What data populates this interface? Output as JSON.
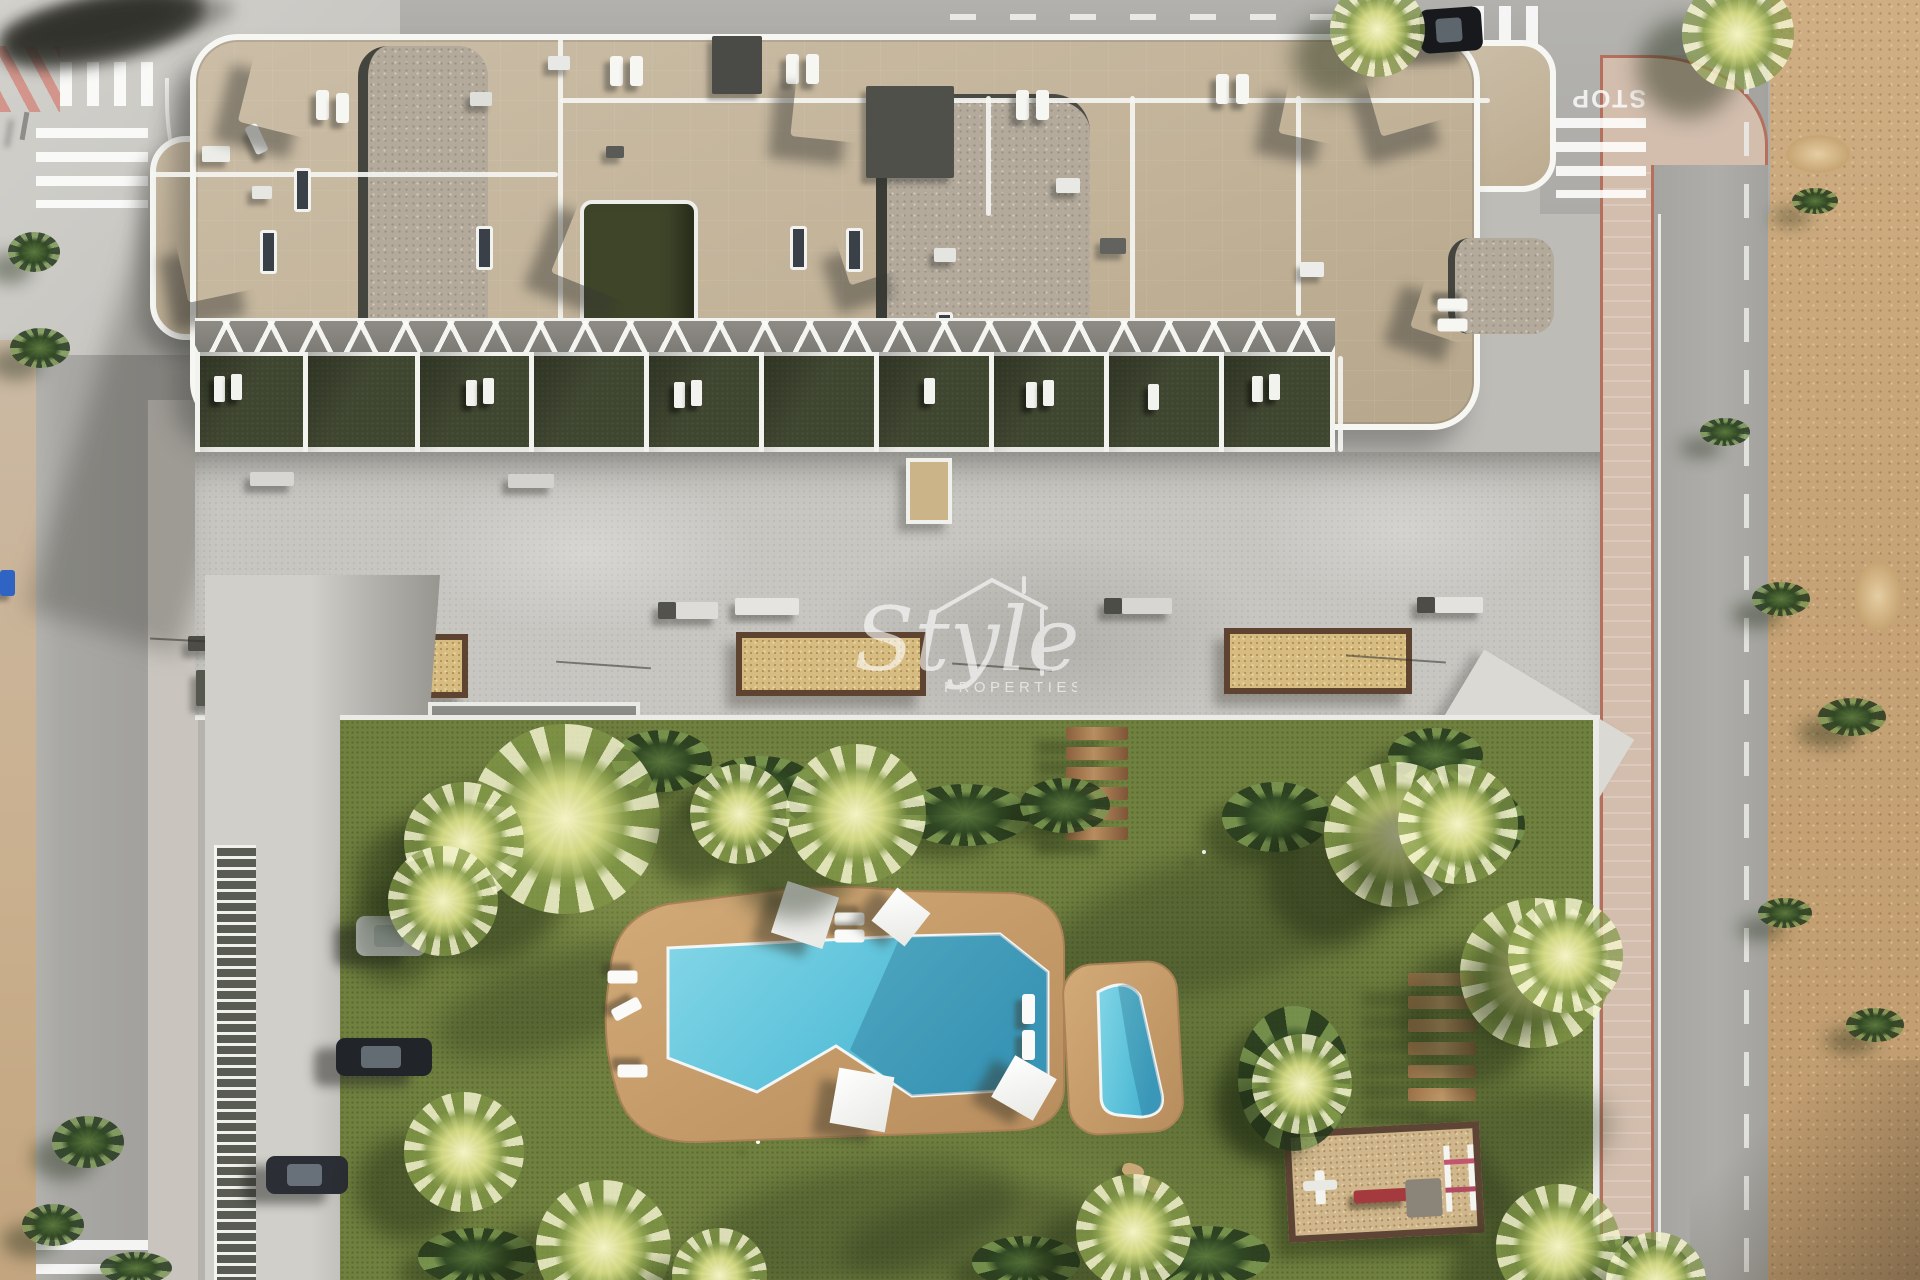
{
  "scene": {
    "description": "aerial-architectural-render-of-residential-complex-with-pool-garden",
    "watermark": {
      "brand_script": "Style",
      "brand_sub": "PROPERTIES"
    },
    "road_markings": {
      "stop_label": "STOP"
    },
    "palette": {
      "asphalt": "#a9a8a4",
      "concrete_plaza": "#c7c6c1",
      "building_stone": "#c2b399",
      "gravel_roof": "#b3aa9c",
      "terrace_grass": "#3f4630",
      "lawn_green": "#70803f",
      "pool_water": "#5fc8de",
      "pool_water_shadow": "#3e9ec0",
      "deck_tan": "#c59d6d",
      "planter_sand": "#d6bc80",
      "sidewalk_pink": "#d3beae",
      "sand_lot": "#c7a477",
      "wood_brown": "#9a7148",
      "white_architecture": "#f6f6f3"
    }
  },
  "sprites": {
    "sails": [
      {
        "x": 246,
        "y": 54,
        "s": 78,
        "r": "14deg"
      },
      {
        "x": 180,
        "y": 222,
        "s": 74,
        "r": "-12deg"
      },
      {
        "x": 564,
        "y": 204,
        "s": 88,
        "r": "22deg"
      },
      {
        "x": 794,
        "y": 66,
        "s": 74,
        "r": "6deg"
      },
      {
        "x": 840,
        "y": 220,
        "s": 58,
        "r": "-18deg"
      },
      {
        "x": 1284,
        "y": 78,
        "s": 62,
        "r": "12deg"
      },
      {
        "x": 1370,
        "y": 54,
        "s": 74,
        "r": "-16deg"
      },
      {
        "x": 1418,
        "y": 276,
        "s": 62,
        "r": "18deg"
      }
    ],
    "roof_units": [
      {
        "x": 202,
        "y": 146,
        "w": 28,
        "h": 16,
        "c": "#ecece9"
      },
      {
        "x": 252,
        "y": 186,
        "w": 20,
        "h": 13,
        "c": "#e6e6e3"
      },
      {
        "x": 470,
        "y": 92,
        "w": 22,
        "h": 14,
        "c": "#dededb"
      },
      {
        "x": 712,
        "y": 36,
        "w": 50,
        "h": 58,
        "c": "#4a4a46"
      },
      {
        "x": 866,
        "y": 86,
        "w": 88,
        "h": 92,
        "c": "#50504b"
      },
      {
        "x": 1056,
        "y": 178,
        "w": 24,
        "h": 15,
        "c": "#e8e8e5"
      },
      {
        "x": 1100,
        "y": 238,
        "w": 26,
        "h": 16,
        "c": "#62625e"
      },
      {
        "x": 934,
        "y": 248,
        "w": 22,
        "h": 14,
        "c": "#e4e4e1"
      },
      {
        "x": 1300,
        "y": 262,
        "w": 24,
        "h": 15,
        "c": "#ececea"
      },
      {
        "x": 548,
        "y": 56,
        "w": 22,
        "h": 14,
        "c": "#e8e8e6"
      },
      {
        "x": 606,
        "y": 146,
        "w": 18,
        "h": 12,
        "c": "#5a5a56"
      }
    ],
    "skylights": [
      {
        "x": 294,
        "y": 168
      },
      {
        "x": 260,
        "y": 230
      },
      {
        "x": 476,
        "y": 226
      },
      {
        "x": 790,
        "y": 226
      },
      {
        "x": 846,
        "y": 228
      },
      {
        "x": 936,
        "y": 312
      }
    ],
    "roof_loungers": [
      {
        "x": 316,
        "y": 90
      },
      {
        "x": 336,
        "y": 93
      },
      {
        "x": 250,
        "y": 124,
        "r": "-25deg"
      },
      {
        "x": 262,
        "y": 326,
        "r": "90deg"
      },
      {
        "x": 262,
        "y": 344,
        "r": "90deg"
      },
      {
        "x": 292,
        "y": 318
      },
      {
        "x": 610,
        "y": 56
      },
      {
        "x": 630,
        "y": 56
      },
      {
        "x": 786,
        "y": 54
      },
      {
        "x": 806,
        "y": 54
      },
      {
        "x": 1016,
        "y": 90
      },
      {
        "x": 1036,
        "y": 90
      },
      {
        "x": 1216,
        "y": 74
      },
      {
        "x": 1236,
        "y": 74
      },
      {
        "x": 1446,
        "y": 290,
        "r": "90deg"
      },
      {
        "x": 1446,
        "y": 310,
        "r": "90deg"
      }
    ],
    "terrace_cells": [
      {
        "x": 195,
        "w": 108
      },
      {
        "x": 303,
        "w": 112
      },
      {
        "x": 415,
        "w": 114
      },
      {
        "x": 529,
        "w": 115
      },
      {
        "x": 644,
        "w": 115
      },
      {
        "x": 759,
        "w": 115
      },
      {
        "x": 874,
        "w": 115
      },
      {
        "x": 989,
        "w": 115
      },
      {
        "x": 1104,
        "w": 115
      },
      {
        "x": 1219,
        "w": 116
      }
    ],
    "terrace_loungers": [
      {
        "x": 214,
        "y": 376
      },
      {
        "x": 231,
        "y": 374
      },
      {
        "x": 466,
        "y": 380
      },
      {
        "x": 483,
        "y": 378
      },
      {
        "x": 674,
        "y": 382
      },
      {
        "x": 691,
        "y": 380
      },
      {
        "x": 924,
        "y": 378
      },
      {
        "x": 1026,
        "y": 382
      },
      {
        "x": 1043,
        "y": 380
      },
      {
        "x": 1252,
        "y": 376
      },
      {
        "x": 1269,
        "y": 374
      },
      {
        "x": 1148,
        "y": 384
      }
    ],
    "planters": [
      {
        "x": 318,
        "y": 634,
        "w": 150,
        "h": 64
      },
      {
        "x": 736,
        "y": 632,
        "w": 190,
        "h": 64
      },
      {
        "x": 1224,
        "y": 628,
        "w": 188,
        "h": 66
      }
    ],
    "plaza_benches": [
      {
        "x": 208,
        "y": 636,
        "w": 80,
        "h": 15,
        "c": "#eceae6"
      },
      {
        "x": 188,
        "y": 636,
        "w": 20,
        "h": 15,
        "c": "#4c4d47"
      },
      {
        "x": 196,
        "y": 670,
        "w": 22,
        "h": 36,
        "c": "#56574f"
      },
      {
        "x": 676,
        "y": 602,
        "w": 42,
        "h": 17,
        "c": "#dedcd8"
      },
      {
        "x": 658,
        "y": 602,
        "w": 18,
        "h": 17,
        "c": "#52534d"
      },
      {
        "x": 735,
        "y": 598,
        "w": 64,
        "h": 17,
        "c": "#e6e4e0"
      },
      {
        "x": 1122,
        "y": 598,
        "w": 50,
        "h": 16,
        "c": "#d8d6d2"
      },
      {
        "x": 1104,
        "y": 598,
        "w": 18,
        "h": 16,
        "c": "#4c4d47"
      },
      {
        "x": 1435,
        "y": 597,
        "w": 48,
        "h": 16,
        "c": "#e4e2de"
      },
      {
        "x": 1417,
        "y": 597,
        "w": 18,
        "h": 16,
        "c": "#4c4d47"
      },
      {
        "x": 508,
        "y": 474,
        "w": 46,
        "h": 14,
        "c": "#d4d2ce"
      },
      {
        "x": 250,
        "y": 472,
        "w": 44,
        "h": 14,
        "c": "#d8d6d2"
      }
    ],
    "pole_shadows": [
      {
        "x": 556,
        "y": 664,
        "w": 95,
        "r": "4deg"
      },
      {
        "x": 952,
        "y": 666,
        "w": 100,
        "r": "4deg"
      },
      {
        "x": 1346,
        "y": 658,
        "w": 100,
        "r": "4deg"
      },
      {
        "x": 150,
        "y": 642,
        "w": 170,
        "r": "3deg"
      }
    ],
    "wood_steps": [
      {
        "x": 1066,
        "y": 727
      },
      {
        "x": 1066,
        "y": 747
      },
      {
        "x": 1066,
        "y": 767
      },
      {
        "x": 1066,
        "y": 787
      },
      {
        "x": 1066,
        "y": 807
      },
      {
        "x": 1066,
        "y": 827
      }
    ],
    "wood_benches": [
      {
        "x": 1408,
        "y": 973
      },
      {
        "x": 1408,
        "y": 996
      },
      {
        "x": 1408,
        "y": 1019
      },
      {
        "x": 1408,
        "y": 1042
      },
      {
        "x": 1408,
        "y": 1065
      },
      {
        "x": 1408,
        "y": 1088
      }
    ],
    "parking_lines": [
      {
        "x": 366,
        "y": 912
      },
      {
        "x": 366,
        "y": 995
      },
      {
        "x": 364,
        "y": 1080
      },
      {
        "x": 362,
        "y": 1155
      },
      {
        "x": 360,
        "y": 1235
      }
    ],
    "cars": [
      {
        "x": 356,
        "y": 916,
        "w": 70,
        "h": 40,
        "c": "#e8e9eb"
      },
      {
        "x": 336,
        "y": 1038,
        "w": 96,
        "h": 38,
        "c": "#212429"
      },
      {
        "x": 266,
        "y": 1156,
        "w": 82,
        "h": 38,
        "c": "#2b2e34"
      },
      {
        "x": 1420,
        "y": 8,
        "w": 62,
        "h": 44,
        "c": "#17191d",
        "r": "-4deg"
      }
    ],
    "light_dots": [
      {
        "x": 866,
        "y": 796
      },
      {
        "x": 1202,
        "y": 850
      },
      {
        "x": 756,
        "y": 1140
      }
    ],
    "lawn_shadows": [
      {
        "x": 430,
        "y": 952,
        "w": 270,
        "h": 95,
        "r": "-18deg"
      },
      {
        "x": 690,
        "y": 1165,
        "w": 330,
        "h": 115,
        "r": "-12deg"
      },
      {
        "x": 1030,
        "y": 850,
        "w": 390,
        "h": 135,
        "r": "-16deg"
      },
      {
        "x": 1310,
        "y": 1105,
        "w": 310,
        "h": 125,
        "r": "-20deg"
      },
      {
        "x": 468,
        "y": 756,
        "w": 200,
        "h": 80,
        "r": "-15deg"
      },
      {
        "x": 840,
        "y": 1190,
        "w": 260,
        "h": 90,
        "r": "-10deg"
      }
    ],
    "road_shadows": [
      {
        "x": 36,
        "y": 540,
        "w": 205,
        "h": 60,
        "r": "-12deg"
      },
      {
        "x": 24,
        "y": 755,
        "w": 195,
        "h": 60,
        "r": "-12deg"
      },
      {
        "x": 6,
        "y": 1025,
        "w": 205,
        "h": 62,
        "r": "-12deg"
      },
      {
        "x": 1672,
        "y": 12,
        "w": 235,
        "h": 48,
        "r": "-8deg"
      },
      {
        "x": 1694,
        "y": 325,
        "w": 205,
        "h": 52,
        "r": "-14deg"
      },
      {
        "x": 1630,
        "y": 540,
        "w": 175,
        "h": 42,
        "r": "-10deg"
      },
      {
        "x": 1608,
        "y": 1035,
        "w": 205,
        "h": 52,
        "r": "-12deg"
      }
    ],
    "pool_loungers": [
      {
        "x": 616,
        "y": 962,
        "r": "90deg"
      },
      {
        "x": 620,
        "y": 994,
        "r": "62deg"
      },
      {
        "x": 626,
        "y": 1056,
        "r": "90deg"
      },
      {
        "x": 843,
        "y": 904,
        "r": "90deg"
      },
      {
        "x": 843,
        "y": 921,
        "r": "90deg"
      },
      {
        "x": 1022,
        "y": 994
      },
      {
        "x": 1022,
        "y": 1030
      }
    ],
    "parasols": [
      {
        "x": 778,
        "y": 888,
        "s": 54,
        "r": "18deg"
      },
      {
        "x": 880,
        "y": 896,
        "s": 42,
        "r": "38deg"
      },
      {
        "x": 834,
        "y": 1072,
        "s": 56,
        "r": "10deg"
      },
      {
        "x": 1000,
        "y": 1064,
        "s": 48,
        "r": "30deg"
      }
    ],
    "palms": [
      {
        "x": 470,
        "y": 724,
        "s": 190
      },
      {
        "x": 404,
        "y": 782,
        "s": 120
      },
      {
        "x": 388,
        "y": 846,
        "s": 110
      },
      {
        "x": 786,
        "y": 744,
        "s": 140
      },
      {
        "x": 690,
        "y": 764,
        "s": 100
      },
      {
        "x": 1324,
        "y": 762,
        "s": 145
      },
      {
        "x": 1398,
        "y": 764,
        "s": 120
      },
      {
        "x": 1460,
        "y": 898,
        "s": 150
      },
      {
        "x": 1508,
        "y": 898,
        "s": 115
      },
      {
        "x": 404,
        "y": 1092,
        "s": 120
      },
      {
        "x": 536,
        "y": 1180,
        "s": 135
      },
      {
        "x": 672,
        "y": 1228,
        "s": 95
      },
      {
        "x": 1076,
        "y": 1174,
        "s": 115
      },
      {
        "x": 1252,
        "y": 1034,
        "s": 100
      },
      {
        "x": 1496,
        "y": 1184,
        "s": 125
      },
      {
        "x": 1606,
        "y": 1232,
        "s": 100
      },
      {
        "x": 1330,
        "y": -18,
        "s": 95
      },
      {
        "x": 1682,
        "y": -22,
        "s": 112
      }
    ],
    "bushes": [
      {
        "x": 612,
        "y": 730,
        "w": 100,
        "h": 62
      },
      {
        "x": 700,
        "y": 756,
        "w": 120,
        "h": 70
      },
      {
        "x": 900,
        "y": 784,
        "w": 130,
        "h": 62
      },
      {
        "x": 1020,
        "y": 778,
        "w": 90,
        "h": 55
      },
      {
        "x": 1222,
        "y": 782,
        "w": 108,
        "h": 70
      },
      {
        "x": 1430,
        "y": 786,
        "w": 95,
        "h": 78
      },
      {
        "x": 1388,
        "y": 728,
        "w": 95,
        "h": 55
      },
      {
        "x": 418,
        "y": 1228,
        "w": 118,
        "h": 58
      },
      {
        "x": 972,
        "y": 1236,
        "w": 108,
        "h": 52
      },
      {
        "x": 1142,
        "y": 1226,
        "w": 128,
        "h": 60
      },
      {
        "x": 1238,
        "y": 1006,
        "w": 112,
        "h": 145
      },
      {
        "x": 1548,
        "y": 1236,
        "w": 140,
        "h": 55
      },
      {
        "x": 52,
        "y": 1116,
        "w": 72,
        "h": 52
      },
      {
        "x": 22,
        "y": 1204,
        "w": 62,
        "h": 42
      },
      {
        "x": 100,
        "y": 1252,
        "w": 72,
        "h": 32
      },
      {
        "x": 8,
        "y": 232,
        "w": 52,
        "h": 40
      },
      {
        "x": 10,
        "y": 328,
        "w": 60,
        "h": 40
      },
      {
        "x": 1752,
        "y": 582,
        "w": 58,
        "h": 34
      },
      {
        "x": 1818,
        "y": 698,
        "w": 68,
        "h": 38
      },
      {
        "x": 1758,
        "y": 898,
        "w": 54,
        "h": 30
      },
      {
        "x": 1846,
        "y": 1008,
        "w": 58,
        "h": 34
      },
      {
        "x": 1700,
        "y": 418,
        "w": 50,
        "h": 28
      },
      {
        "x": 1792,
        "y": 188,
        "w": 46,
        "h": 26
      }
    ]
  }
}
